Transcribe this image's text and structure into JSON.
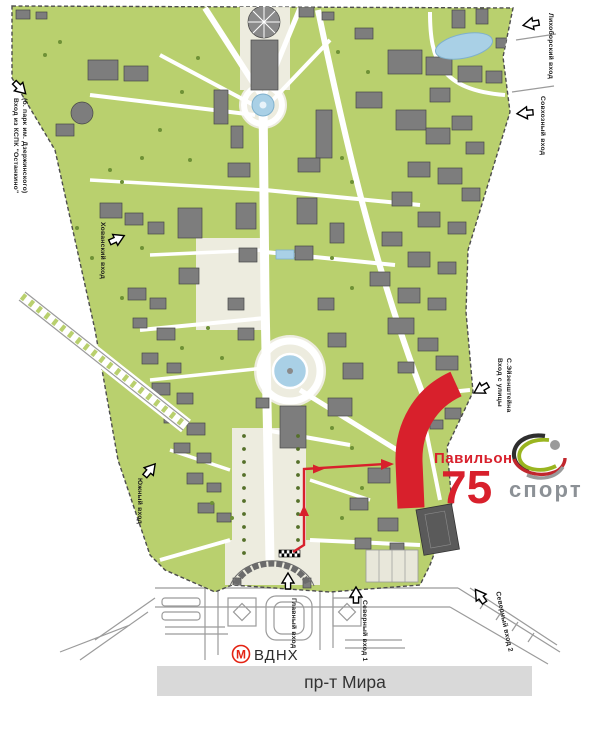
{
  "pavilion": {
    "label": "Павильон",
    "number": "75"
  },
  "logo": {
    "brand": "спорт"
  },
  "metro": {
    "symbol": "М",
    "station": "ВДНХ"
  },
  "street_band": {
    "label": "пр-т Мира"
  },
  "entrances": {
    "kspk_line1": "Вход из КСПК \"Останкино\"",
    "kspk_line2": "(б. парк им. Дзержинского)",
    "likhoborsky": "Лихоборский вход",
    "sovkhozny": "Совхозный вход",
    "eisenstein_line1": "Вход с улицы",
    "eisenstein_line2": "С.Эйзенштейна",
    "khovansky": "Хованский вход",
    "south": "Южный вход",
    "main": "Главный вход",
    "north1": "Северный вход 1",
    "north2": "Северный вход 2"
  },
  "colors": {
    "park_green": "#b9d06e",
    "pavilion_red": "#d8202c",
    "pond_blue": "#a9d0e6",
    "building_gray": "#7d7d7d",
    "street_band_gray": "#d9d9d9",
    "logo_green": "#9ab520",
    "logo_red": "#c1272d",
    "logo_gray": "#9a9a9a",
    "metro_red": "#e42313"
  }
}
